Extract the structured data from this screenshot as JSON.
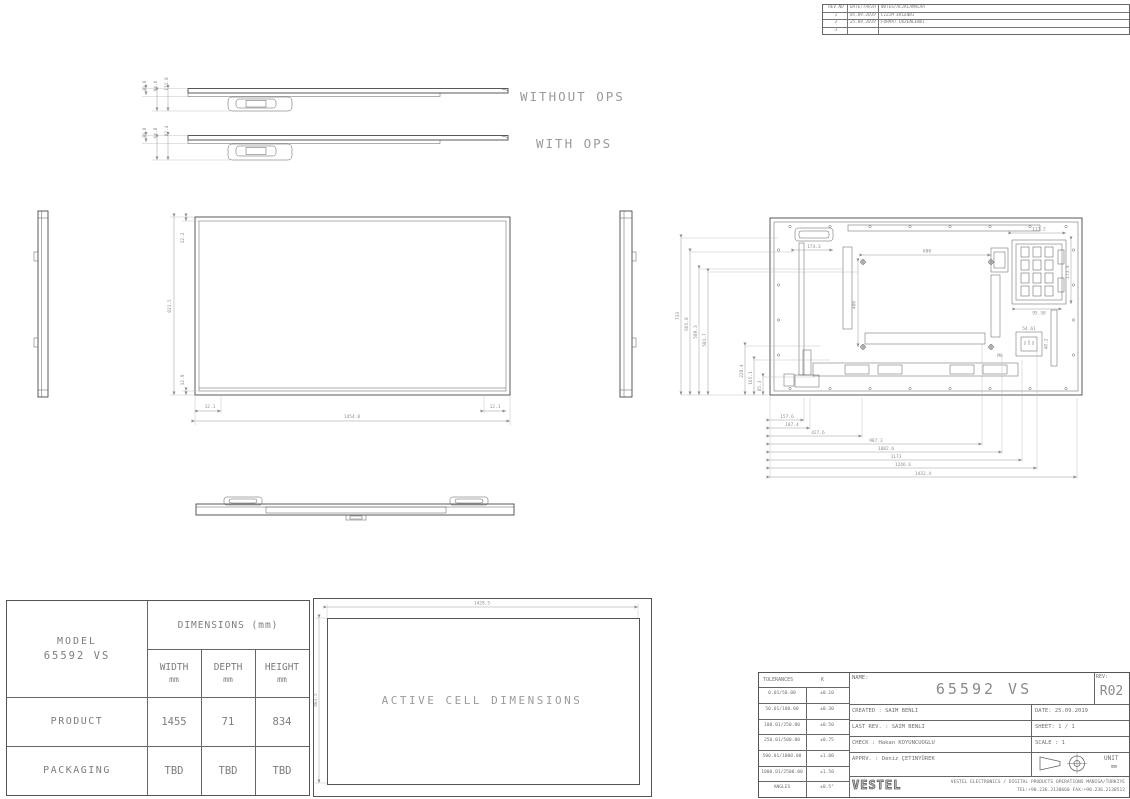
{
  "colors": {
    "line": "#474747",
    "dim": "#8e8e8e",
    "table_border": "#555555"
  },
  "revision_table": {
    "col_no": "REV.NO",
    "col_date": "DATE/TARIH",
    "col_note": "NOTES/ACIKLAMALAR",
    "rows": [
      {
        "no": "1",
        "date": "05.09.2019",
        "note": "CIZIM EKLENDI"
      },
      {
        "no": "2",
        "date": "25.09.2019",
        "note": "FORMAT DUZENLENDI"
      },
      {
        "no": "3",
        "date": "",
        "note": ""
      }
    ]
  },
  "view_labels": {
    "without_ops": "WITHOUT OPS",
    "with_ops": "WITH OPS",
    "active_cell": "ACTIVE CELL DIMENSIONS"
  },
  "dims": {
    "side_a": {
      "a": "30.8",
      "b": "94.6",
      "c": "111.8"
    },
    "side_b": {
      "a": "30.8",
      "b": "64.8",
      "c": "82.4"
    },
    "front": {
      "overall_w": "1454.8",
      "overall_h": "831.5",
      "top": "12.2",
      "bottom": "12.9",
      "corner_l": "12.1",
      "corner_r": "12.1"
    },
    "active": {
      "w": "1428.5",
      "h": "803.5"
    },
    "rear": {
      "left": [
        "733",
        "665.8",
        "589.3",
        "581.7"
      ],
      "left_inner": [
        "228.4",
        "165.1",
        "85.3"
      ],
      "bottom": [
        "157.6",
        "187.4",
        "427.6",
        "987.3",
        "1082.6",
        "1173",
        "1246.6",
        "1432.4"
      ],
      "vesa_h": "600",
      "vesa_v": "400",
      "thread": "M8",
      "handle": "174.3",
      "ops_w": "117.2",
      "ops_h": "173.8",
      "ops_b": "95.58",
      "inlet_w": "54.61",
      "inlet_h": "48.2"
    }
  },
  "spec_table": {
    "model_label": "MODEL",
    "model": "65592 VS",
    "header": "DIMENSIONS (mm)",
    "col1": "WIDTH",
    "col2": "DEPTH",
    "col3": "HEIGHT",
    "unit": "mm",
    "row1_label": "PRODUCT",
    "row1": [
      "1455",
      "71",
      "834"
    ],
    "row2_label": "PACKAGING",
    "row2": [
      "TBD",
      "TBD",
      "TBD"
    ]
  },
  "title_block": {
    "tol_title": "TOLERANCES",
    "tol_k": "K",
    "tol_rows": [
      {
        "r": "0.01/50.00",
        "v": "±0.10"
      },
      {
        "r": "50.01/100.00",
        "v": "±0.30"
      },
      {
        "r": "100.01/250.00",
        "v": "±0.50"
      },
      {
        "r": "250.01/500.00",
        "v": "±0.75"
      },
      {
        "r": "500.01/1000.00",
        "v": "±1.00"
      },
      {
        "r": "1000.01/2500.00",
        "v": "±1.50"
      },
      {
        "r": "ANGLES",
        "v": "±0.5°"
      }
    ],
    "name_label": "NAME:",
    "name": "65592 VS",
    "rev_label": "REV:",
    "rev": "R02",
    "created": "CREATED : SAIM BENLI",
    "date": "DATE: 25.09.2019",
    "last_rev": "LAST REV. : SAIM BENLI",
    "sheet": "SHEET: 1 / 1",
    "check": "CHECK : Hakan KOYUNCUOGLU",
    "scale": "SCALE : 1",
    "apprv": "APPRV. : Deniz ÇETINYÜREK",
    "unit_label": "UNIT",
    "unit": "mm",
    "brand": "VESTEL",
    "company": "VESTEL ELECTRONICS / DIGITAL PRODUCTS OPERATIONS MANISA/TURKIYE",
    "contact": "TEL:+90.236.2130660 FAX:+90.236.2130512"
  }
}
